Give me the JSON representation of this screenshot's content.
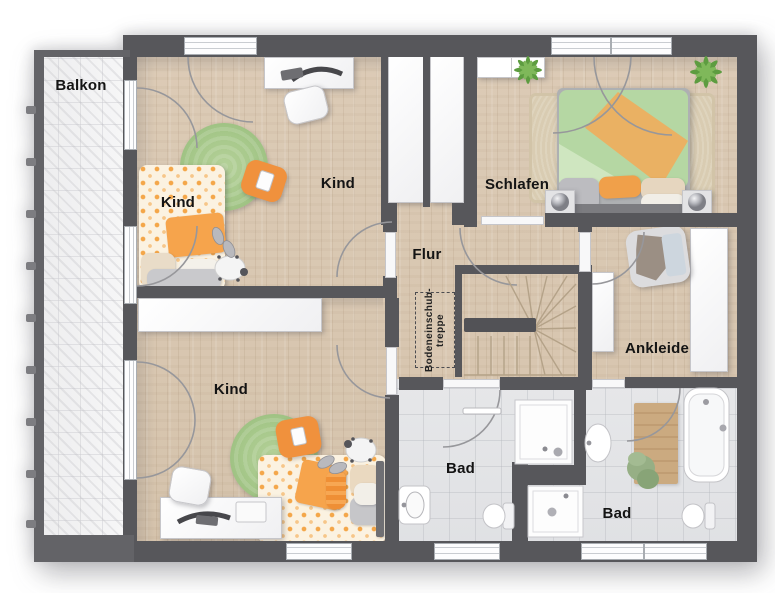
{
  "rooms": {
    "balkon": "Balkon",
    "kind_nw": "Kind",
    "kind_n": "Kind",
    "kind_sw": "Kind",
    "schlafen": "Schlafen",
    "flur": "Flur",
    "ankleide": "Ankleide",
    "bad_mitte": "Bad",
    "bad_ost": "Bad"
  },
  "annotations": {
    "attic_stairs_line1": "Bodeneinschub-",
    "attic_stairs_line2": "treppe"
  },
  "palette": {
    "wall": "#57575b",
    "wood_floor": "#d8c6b0",
    "bath_tile": "#e4e5e7",
    "balcony_tile": "#f3f3f4",
    "accent_orange": "#f2993f",
    "rug_green": "#a5c789",
    "duvet_green": "#b5d7a3",
    "label_color": "#141414"
  }
}
